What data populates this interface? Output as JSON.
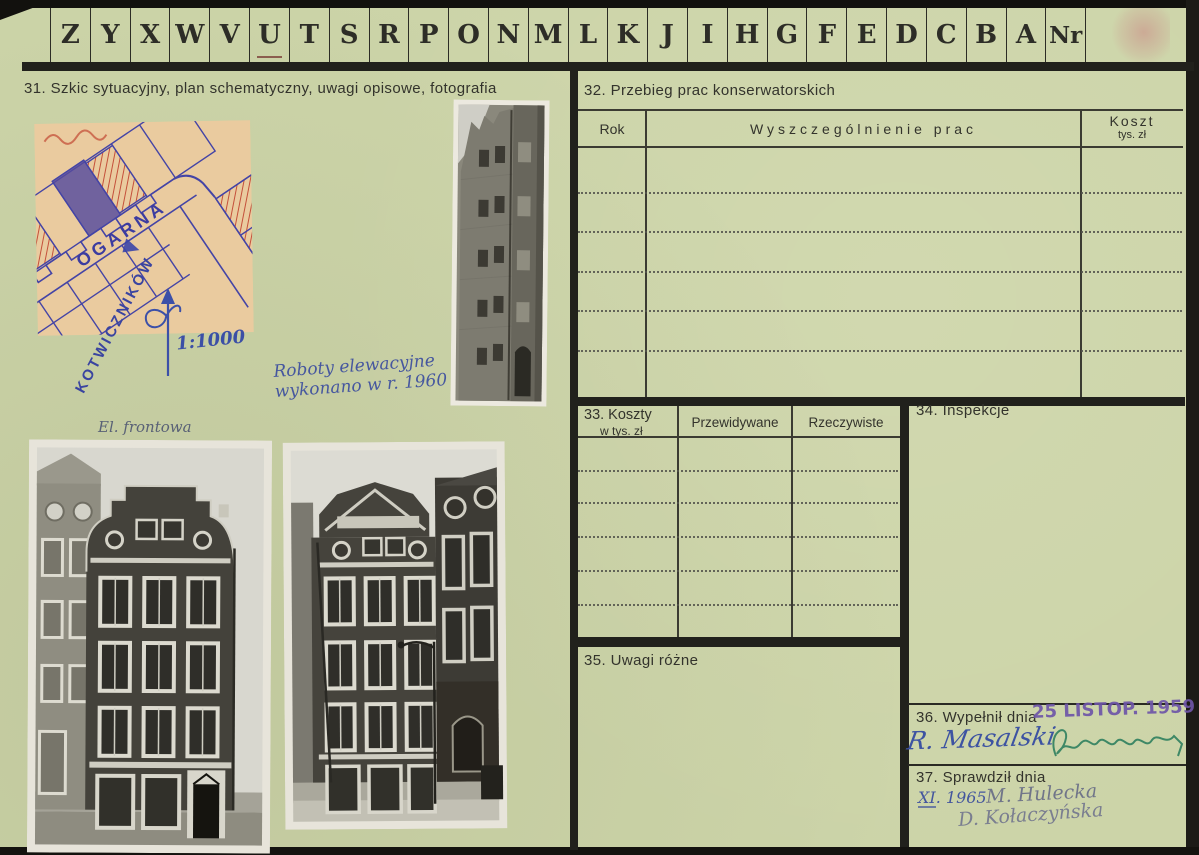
{
  "tabs": {
    "letters": [
      "Z",
      "Y",
      "X",
      "W",
      "V",
      "U",
      "T",
      "S",
      "R",
      "P",
      "O",
      "N",
      "M",
      "L",
      "K",
      "J",
      "I",
      "H",
      "G",
      "F",
      "E",
      "D",
      "C",
      "B",
      "A"
    ],
    "nr_label": "Nr",
    "underlined": "U"
  },
  "section31": {
    "title": "31. Szkic sytuacyjny, plan schematyczny, uwagi opisowe, fotografia",
    "map_street_1": "OGARNA",
    "map_street_2": "KOTWICZNIKÓW",
    "map_scale": "1:1000",
    "note_line1": "Roboty elewacyjne",
    "note_line2": "wykonano w r. 1960",
    "photo_caption": "El. frontowa"
  },
  "section32": {
    "title": "32. Przebieg prac konserwatorskich",
    "columns": {
      "rok": "Rok",
      "prace": "Wyszczególnienie prac",
      "koszt": "Koszt",
      "koszt_sub": "tys. zł"
    }
  },
  "section33": {
    "number_title": "33. Koszty",
    "subtitle": "w tys. zł",
    "col_przewidywane": "Przewidywane",
    "col_rzeczywiste": "Rzeczywiste"
  },
  "section34": {
    "title": "34. Inspekcje"
  },
  "section35": {
    "title": "35. Uwagi różne"
  },
  "section36": {
    "title": "36. Wypełnił dnia",
    "date_stamp": "25 LISTOP. 1959",
    "signature": "R. Masalski"
  },
  "section37": {
    "title": "37. Sprawdził dnia",
    "date": "XI. 1965",
    "name1": "M. Hulecka",
    "name2": "D. Kołaczyńska"
  },
  "colors": {
    "paper": "#ccd4a8",
    "ink": "#33332c",
    "rule": "#21211c",
    "blue_ink": "#4055a0",
    "stamp_purple": "#6b51a4",
    "green_ink": "#2f7f5e",
    "map_paper": "#eacb9f",
    "map_red": "#c4503a",
    "map_blue": "#3c46a8"
  }
}
